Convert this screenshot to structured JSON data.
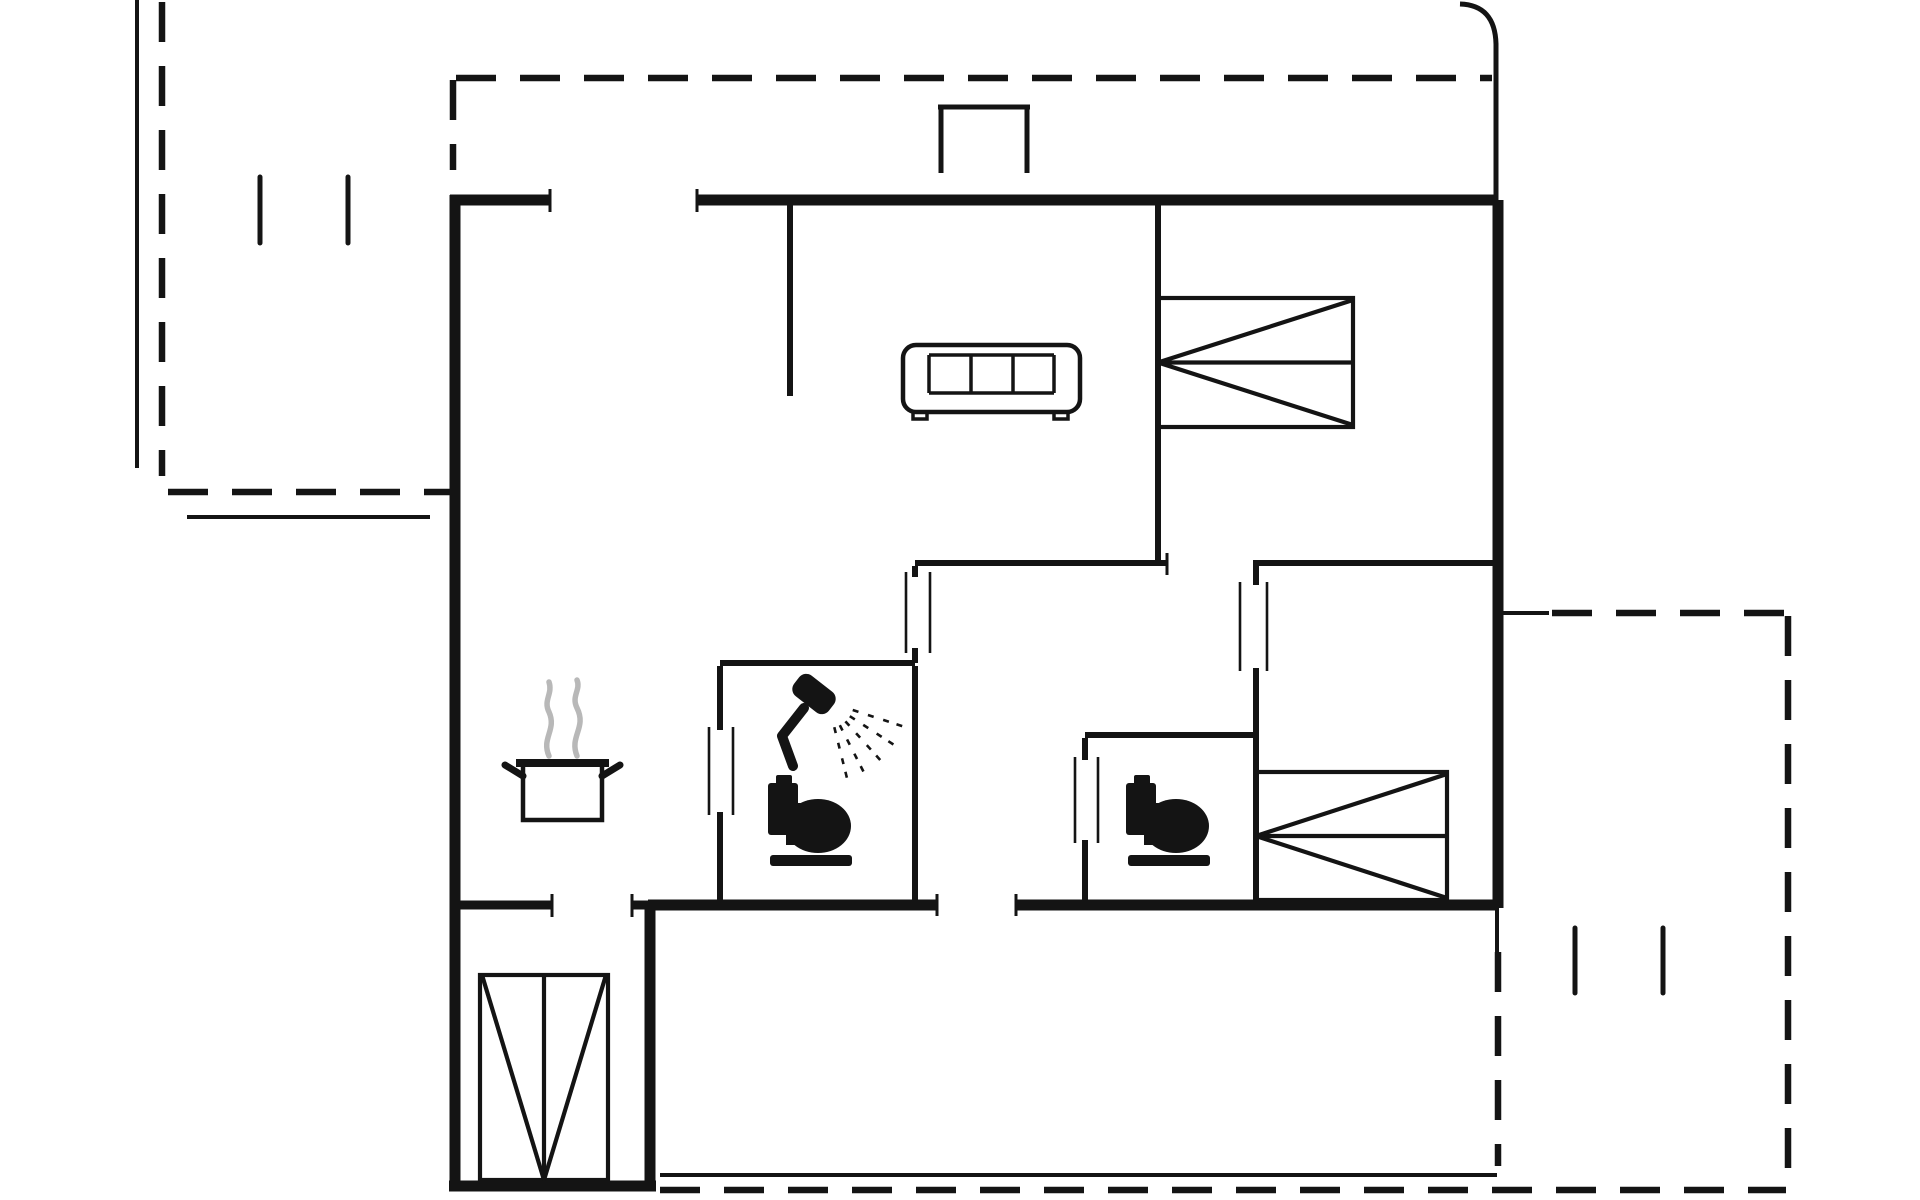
{
  "meta": {
    "title": "Holiday house floor plan",
    "type": "architectural-floor-plan"
  },
  "canvas": {
    "width": 1920,
    "height": 1200,
    "background": "#ffffff"
  },
  "style": {
    "line_color": "#141414",
    "steam_color": "#b8b8b8",
    "thick_wall_width": 11,
    "medium_wall_width": 9,
    "thin_wall_width": 6,
    "porch_width": 5,
    "accent_width": 4,
    "door_mark_width": 2.6,
    "tick_width": 3,
    "terrace_tick_width": 5,
    "dash_width": 6.5,
    "dash_pattern": "40 24",
    "furniture_stroke": 4.5
  },
  "plan": {
    "thick_walls": [
      {
        "name": "wall-top-left-segment",
        "x1": 450,
        "y1": 200,
        "x2": 550,
        "y2": 200
      },
      {
        "name": "wall-top-main",
        "x1": 697,
        "y1": 200,
        "x2": 1498,
        "y2": 200
      },
      {
        "name": "wall-right",
        "x1": 1498,
        "y1": 200,
        "x2": 1498,
        "y2": 908
      },
      {
        "name": "wall-bottom-right",
        "x1": 1016,
        "y1": 905,
        "x2": 1498,
        "y2": 905
      },
      {
        "name": "wall-bottom-center",
        "x1": 648,
        "y1": 905,
        "x2": 937,
        "y2": 905
      },
      {
        "name": "wall-left",
        "x1": 455,
        "y1": 195,
        "x2": 455,
        "y2": 1188
      },
      {
        "name": "wall-utility-bottom",
        "x1": 449,
        "y1": 1186,
        "x2": 656,
        "y2": 1186
      },
      {
        "name": "wall-utility-right",
        "x1": 650,
        "y1": 905,
        "x2": 650,
        "y2": 1188
      }
    ],
    "medium_walls": [
      {
        "name": "wall-kitchen-utility-left",
        "x1": 455,
        "y1": 905,
        "x2": 552,
        "y2": 905
      },
      {
        "name": "wall-kitchen-utility-right",
        "x1": 632,
        "y1": 905,
        "x2": 653,
        "y2": 905
      }
    ],
    "thin_walls": [
      {
        "name": "wall-living-partition",
        "x1": 790,
        "y1": 203,
        "x2": 790,
        "y2": 396
      },
      {
        "name": "wall-bedroom1-left",
        "x1": 1158,
        "y1": 203,
        "x2": 1158,
        "y2": 560
      },
      {
        "name": "wall-hall-top-left",
        "x1": 915,
        "y1": 563,
        "x2": 1167,
        "y2": 563
      },
      {
        "name": "wall-bedroom2-top",
        "x1": 1253,
        "y1": 563,
        "x2": 1498,
        "y2": 563
      },
      {
        "name": "wall-bedroom2-left-upper",
        "x1": 1256,
        "y1": 566,
        "x2": 1256,
        "y2": 585
      },
      {
        "name": "wall-bedroom2-left-lower",
        "x1": 1256,
        "y1": 668,
        "x2": 1256,
        "y2": 902
      },
      {
        "name": "wall-hall-west-upper",
        "x1": 915,
        "y1": 566,
        "x2": 915,
        "y2": 577
      },
      {
        "name": "wall-hall-west-lower",
        "x1": 915,
        "y1": 648,
        "x2": 915,
        "y2": 663
      },
      {
        "name": "wall-bathroom-top",
        "x1": 720,
        "y1": 663,
        "x2": 915,
        "y2": 663
      },
      {
        "name": "wall-bathroom-left-upper",
        "x1": 720,
        "y1": 666,
        "x2": 720,
        "y2": 730
      },
      {
        "name": "wall-bathroom-left-lower",
        "x1": 720,
        "y1": 812,
        "x2": 720,
        "y2": 902
      },
      {
        "name": "wall-bathroom-right",
        "x1": 915,
        "y1": 666,
        "x2": 915,
        "y2": 902
      },
      {
        "name": "wall-wc-top",
        "x1": 1085,
        "y1": 735,
        "x2": 1253,
        "y2": 735
      },
      {
        "name": "wall-wc-left-upper",
        "x1": 1085,
        "y1": 738,
        "x2": 1085,
        "y2": 760
      },
      {
        "name": "wall-wc-left-lower",
        "x1": 1085,
        "y1": 840,
        "x2": 1085,
        "y2": 902
      }
    ],
    "porch_lines": [
      {
        "name": "entrance-porch-left",
        "x1": 941,
        "y1": 107,
        "x2": 941,
        "y2": 173
      },
      {
        "name": "entrance-porch-right",
        "x1": 1027,
        "y1": 107,
        "x2": 1027,
        "y2": 173
      },
      {
        "name": "entrance-porch-top",
        "x1": 938,
        "y1": 107,
        "x2": 1030,
        "y2": 107
      }
    ],
    "door_marks": [
      {
        "name": "door-bathroom-jamb-outer",
        "x1": 709,
        "y1": 727,
        "x2": 709,
        "y2": 815
      },
      {
        "name": "door-bathroom-jamb-inner",
        "x1": 733,
        "y1": 727,
        "x2": 733,
        "y2": 815
      },
      {
        "name": "door-hall-jamb-outer",
        "x1": 906,
        "y1": 572,
        "x2": 906,
        "y2": 653
      },
      {
        "name": "door-hall-jamb-inner",
        "x1": 930,
        "y1": 572,
        "x2": 930,
        "y2": 653
      },
      {
        "name": "door-bedroom2-jamb-outer",
        "x1": 1240,
        "y1": 582,
        "x2": 1240,
        "y2": 671
      },
      {
        "name": "door-bedroom2-jamb-inner",
        "x1": 1267,
        "y1": 582,
        "x2": 1267,
        "y2": 671
      },
      {
        "name": "door-wc-jamb-outer",
        "x1": 1075,
        "y1": 757,
        "x2": 1075,
        "y2": 843
      },
      {
        "name": "door-wc-jamb-inner",
        "x1": 1098,
        "y1": 757,
        "x2": 1098,
        "y2": 843
      }
    ],
    "wall_end_ticks": [
      {
        "name": "tick-front-door-left",
        "x1": 550,
        "y1": 189,
        "x2": 550,
        "y2": 212
      },
      {
        "name": "tick-front-door-right",
        "x1": 697,
        "y1": 189,
        "x2": 697,
        "y2": 212
      },
      {
        "name": "tick-utility-door-left",
        "x1": 552,
        "y1": 894,
        "x2": 552,
        "y2": 917
      },
      {
        "name": "tick-utility-door-right",
        "x1": 632,
        "y1": 894,
        "x2": 632,
        "y2": 917
      },
      {
        "name": "tick-back-door-left",
        "x1": 937,
        "y1": 894,
        "x2": 937,
        "y2": 916
      },
      {
        "name": "tick-back-door-right",
        "x1": 1016,
        "y1": 894,
        "x2": 1016,
        "y2": 916
      },
      {
        "name": "tick-bedroom1-doorway",
        "x1": 1167,
        "y1": 553,
        "x2": 1167,
        "y2": 575
      }
    ],
    "terrace_ticks": [
      {
        "name": "terrace-nw-tick-1",
        "x1": 260,
        "y1": 177,
        "x2": 260,
        "y2": 243
      },
      {
        "name": "terrace-nw-tick-2",
        "x1": 348,
        "y1": 177,
        "x2": 348,
        "y2": 243
      },
      {
        "name": "terrace-e-tick-1",
        "x1": 1575,
        "y1": 928,
        "x2": 1575,
        "y2": 993
      },
      {
        "name": "terrace-e-tick-2",
        "x1": 1663,
        "y1": 928,
        "x2": 1663,
        "y2": 993
      }
    ],
    "accent_lines": [
      {
        "name": "terrace-nw-outer-edge",
        "x1": 137,
        "y1": 0,
        "x2": 137,
        "y2": 468
      },
      {
        "name": "terrace-nw-step-edge",
        "x1": 187,
        "y1": 517,
        "x2": 430,
        "y2": 517
      },
      {
        "name": "terrace-s-deck-edge",
        "x1": 660,
        "y1": 1175,
        "x2": 1497,
        "y2": 1175
      },
      {
        "name": "terrace-e-solid-stub",
        "x1": 1500,
        "y1": 613,
        "x2": 1549,
        "y2": 613
      },
      {
        "name": "wall-right-lower-stub",
        "x1": 1497,
        "y1": 908,
        "x2": 1497,
        "y2": 952
      }
    ],
    "paths": [
      {
        "name": "roof-outline-top-right-corner",
        "d": "M 1460 4 Q 1495 5 1496 44 L 1496 200",
        "w": 5
      }
    ],
    "dashed_lines": [
      {
        "name": "terrace-nw-left-boundary",
        "x1": 162,
        "y1": 2,
        "x2": 162,
        "y2": 476
      },
      {
        "name": "terrace-nw-bottom-boundary",
        "x1": 168,
        "y1": 492,
        "x2": 450,
        "y2": 492
      },
      {
        "name": "terrace-nw-right-boundary",
        "x1": 453,
        "y1": 80,
        "x2": 453,
        "y2": 170
      },
      {
        "name": "terrace-n-boundary",
        "x1": 456,
        "y1": 78,
        "x2": 1492,
        "y2": 78
      },
      {
        "name": "terrace-e-top-boundary",
        "x1": 1552,
        "y1": 613,
        "x2": 1786,
        "y2": 613
      },
      {
        "name": "terrace-e-right-boundary",
        "x1": 1788,
        "y1": 616,
        "x2": 1788,
        "y2": 1186
      },
      {
        "name": "terrace-s-bottom-boundary",
        "x1": 660,
        "y1": 1190,
        "x2": 1786,
        "y2": 1190
      },
      {
        "name": "terrace-se-house-line",
        "x1": 1498,
        "y1": 952,
        "x2": 1498,
        "y2": 1166
      }
    ]
  },
  "furniture": {
    "sofa": {
      "name": "sofa-icon",
      "x": 903,
      "y": 345,
      "w": 177,
      "h": 67
    },
    "cooking_pot": {
      "name": "cooking-pot-icon",
      "x": 503,
      "y": 680
    },
    "shower": {
      "name": "shower-icon",
      "x": 752,
      "y": 672
    },
    "toilets": [
      {
        "name": "toilet-bathroom-icon",
        "x": 768,
        "y": 775
      },
      {
        "name": "toilet-wc-icon",
        "x": 1126,
        "y": 775
      }
    ],
    "beds": [
      {
        "name": "bed-bedroom1-icon",
        "x": 1158,
        "y": 298,
        "w": 195,
        "h": 129,
        "apex": "left"
      },
      {
        "name": "bed-bedroom2-icon",
        "x": 1256,
        "y": 772,
        "w": 191,
        "h": 128,
        "apex": "left"
      },
      {
        "name": "bed-utility-icon",
        "x": 480,
        "y": 975,
        "w": 128,
        "h": 205,
        "apex": "bottom"
      }
    ]
  }
}
